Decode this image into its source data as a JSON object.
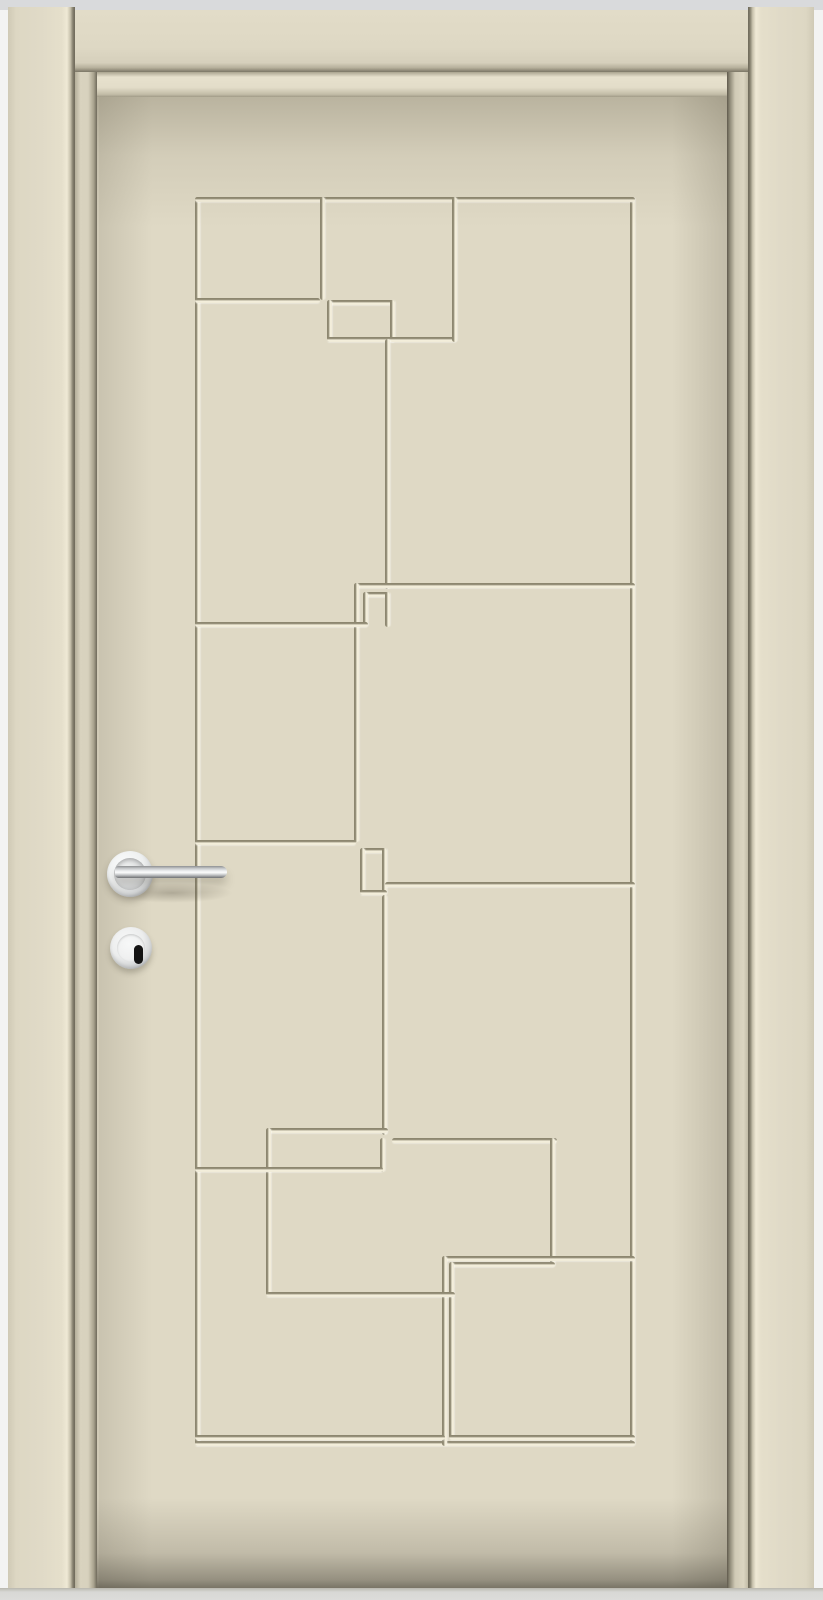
{
  "meta": {
    "scene": "Closed cream-painted interior door, straight-on product view",
    "door_style": "flush door with engraved geometric rectangle groove pattern"
  },
  "colors": {
    "background": "#f3f3f2",
    "wall_top": "#d9dadc",
    "casing": "#ded8c4",
    "casing_edge_shadow": "#6e695a",
    "reveal": "#d9d3bf",
    "leaf": "#dfd9c5",
    "groove_dark": "#8d8770",
    "groove_light": "#f7f2df",
    "floor": "#d8d8d5",
    "chrome_light": "#fafbfb",
    "chrome_mid": "#c9cbcd",
    "chrome_dark": "#7e8082",
    "keyhole": "#141414"
  },
  "frame": {
    "left_casing": "left door casing board",
    "right_casing": "right door casing board",
    "head_casing": "top head casing board",
    "jamb_reveal": "inner jamb reveal around leaf"
  },
  "pattern": {
    "groove_thickness": 5,
    "segments": [
      {
        "id": "outer-left",
        "o": "v",
        "x": 98,
        "y": 100,
        "len": 1249
      },
      {
        "id": "outer-right",
        "o": "v",
        "x": 533,
        "y": 100,
        "len": 1249
      },
      {
        "id": "outer-top",
        "o": "h",
        "x": 98,
        "y": 100,
        "len": 440
      },
      {
        "id": "outer-bottom",
        "o": "h",
        "x": 98,
        "y": 1344,
        "len": 440
      },
      {
        "id": "top-divider-1",
        "o": "v",
        "x": 223,
        "y": 100,
        "len": 103
      },
      {
        "id": "topleft-cell-bottom",
        "o": "h",
        "x": 98,
        "y": 201,
        "len": 125
      },
      {
        "id": "box1-top",
        "o": "h",
        "x": 230,
        "y": 203,
        "len": 68
      },
      {
        "id": "box1-left",
        "o": "v",
        "x": 230,
        "y": 203,
        "len": 42
      },
      {
        "id": "box1-right",
        "o": "v",
        "x": 293,
        "y": 203,
        "len": 42
      },
      {
        "id": "box1-bottom",
        "o": "h",
        "x": 230,
        "y": 240,
        "len": 68
      },
      {
        "id": "box1-connector",
        "o": "h",
        "x": 293,
        "y": 240,
        "len": 67
      },
      {
        "id": "top-divider-2",
        "o": "v",
        "x": 355,
        "y": 100,
        "len": 145
      },
      {
        "id": "center-vert-1",
        "o": "v",
        "x": 288,
        "y": 242,
        "len": 250
      },
      {
        "id": "mid-right-top",
        "o": "h",
        "x": 257,
        "y": 486,
        "len": 281
      },
      {
        "id": "center-vert-2",
        "o": "v",
        "x": 257,
        "y": 486,
        "len": 259
      },
      {
        "id": "box2-top",
        "o": "h",
        "x": 266,
        "y": 495,
        "len": 27
      },
      {
        "id": "box2-left",
        "o": "v",
        "x": 266,
        "y": 495,
        "len": 35
      },
      {
        "id": "box2-right",
        "o": "v",
        "x": 288,
        "y": 495,
        "len": 35
      },
      {
        "id": "left-cell-divider-1",
        "o": "h",
        "x": 98,
        "y": 525,
        "len": 173
      },
      {
        "id": "left-cell-divider-2",
        "o": "h",
        "x": 98,
        "y": 743,
        "len": 161
      },
      {
        "id": "box3-top",
        "o": "h",
        "x": 263,
        "y": 751,
        "len": 27
      },
      {
        "id": "box3-left",
        "o": "v",
        "x": 263,
        "y": 751,
        "len": 47
      },
      {
        "id": "box3-right",
        "o": "v",
        "x": 285,
        "y": 751,
        "len": 47
      },
      {
        "id": "box3-bottom",
        "o": "h",
        "x": 263,
        "y": 793,
        "len": 27
      },
      {
        "id": "mid-right-bottom",
        "o": "h",
        "x": 288,
        "y": 785,
        "len": 250
      },
      {
        "id": "center-vert-3",
        "o": "v",
        "x": 285,
        "y": 798,
        "len": 240
      },
      {
        "id": "widebox-top-left",
        "o": "h",
        "x": 169,
        "y": 1031,
        "len": 122
      },
      {
        "id": "widebox-left",
        "o": "v",
        "x": 169,
        "y": 1031,
        "len": 169
      },
      {
        "id": "widebox-top-right",
        "o": "h",
        "x": 295,
        "y": 1041,
        "len": 165
      },
      {
        "id": "widebox-link-vert",
        "o": "v",
        "x": 283,
        "y": 1041,
        "len": 34
      },
      {
        "id": "left-cell-divider-3",
        "o": "h",
        "x": 98,
        "y": 1070,
        "len": 188
      },
      {
        "id": "widebox-right",
        "o": "v",
        "x": 453,
        "y": 1041,
        "len": 129
      },
      {
        "id": "widebox-bottom-inner",
        "o": "h",
        "x": 353,
        "y": 1165,
        "len": 105
      },
      {
        "id": "bottomright-cell-top",
        "o": "h",
        "x": 345,
        "y": 1159,
        "len": 193
      },
      {
        "id": "bottom-divider-a",
        "o": "v",
        "x": 345,
        "y": 1159,
        "len": 190
      },
      {
        "id": "bottom-divider-b",
        "o": "v",
        "x": 352,
        "y": 1165,
        "len": 178
      },
      {
        "id": "widebox-bottom",
        "o": "h",
        "x": 169,
        "y": 1195,
        "len": 189
      },
      {
        "id": "bottomleft-cell-bottom",
        "o": "h",
        "x": 98,
        "y": 1338,
        "len": 250
      },
      {
        "id": "bottomright-cell-bottom",
        "o": "h",
        "x": 352,
        "y": 1338,
        "len": 186
      }
    ]
  },
  "hardware": {
    "lever_handle": {
      "finish": "polished chrome",
      "rose": {
        "cx": 130,
        "cy": 874,
        "r": 23
      },
      "bar": {
        "x": 115,
        "y": 869,
        "w": 112,
        "h": 12
      }
    },
    "keyhole_escutcheon": {
      "finish": "polished chrome",
      "cx": 131,
      "cy": 948,
      "r": 21,
      "keyhole": {
        "w": 9,
        "h": 19
      }
    }
  }
}
